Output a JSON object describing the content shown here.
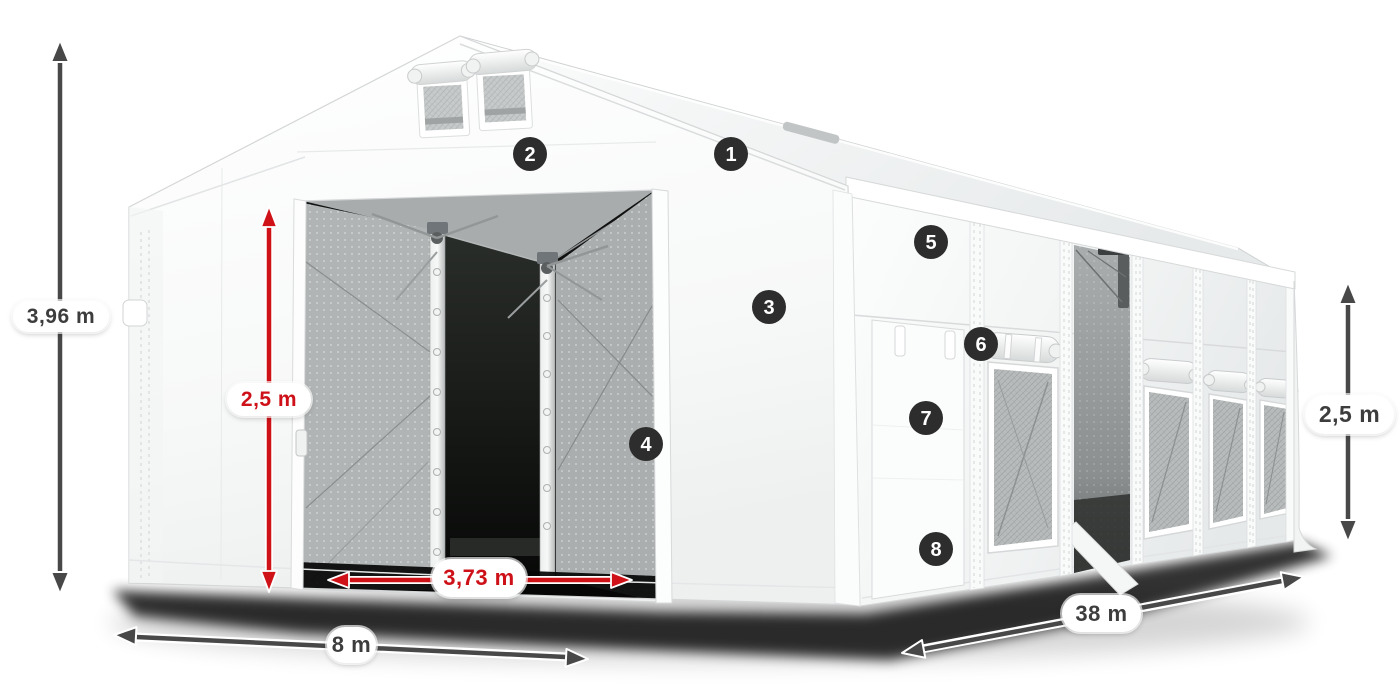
{
  "page": {
    "background": "#ffffff",
    "subject": "tent-dimensions-diagram"
  },
  "colors": {
    "dimension_arrow_dark": "#484848",
    "dimension_arrow_red": "#cf1217",
    "badge_background": "#2d2d2d",
    "badge_number": "#ffffff",
    "pill_background": "#ffffff",
    "pill_text_dark": "#3d3d3d",
    "pill_text_red": "#ce1118",
    "tent_fabric": "#ffffff",
    "mesh_gray": "#b0b4b4",
    "ground_shadow": "#000000"
  },
  "dimensions": {
    "total_height": {
      "value": "3,96 m",
      "style": "dark",
      "orientation": "vertical"
    },
    "door_height": {
      "value": "2,5 m",
      "style": "red",
      "orientation": "vertical"
    },
    "door_width": {
      "value": "3,73 m",
      "style": "red",
      "orientation": "horizontal"
    },
    "front_width": {
      "value": "8 m",
      "style": "dark",
      "orientation": "horizontal"
    },
    "side_length": {
      "value": "38 m",
      "style": "dark",
      "orientation": "horizontal"
    },
    "side_height": {
      "value": "2,5 m",
      "style": "dark",
      "orientation": "vertical"
    }
  },
  "feature_markers": [
    {
      "number": "1"
    },
    {
      "number": "2"
    },
    {
      "number": "3"
    },
    {
      "number": "4"
    },
    {
      "number": "5"
    },
    {
      "number": "6"
    },
    {
      "number": "7"
    },
    {
      "number": "8"
    }
  ]
}
